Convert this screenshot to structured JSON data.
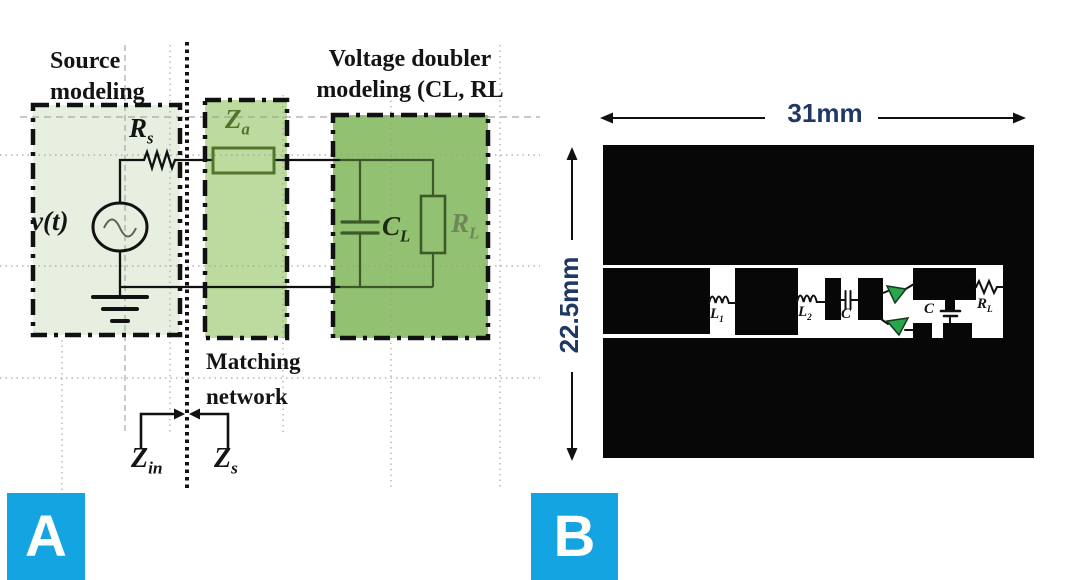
{
  "figure": {
    "panel_a": {
      "badge": "A",
      "source_title": {
        "line1": "Source",
        "line2": "modeling"
      },
      "doubler_title": {
        "line1": "Voltage doubler",
        "line2": "modeling (CL, RL"
      },
      "matching_label": {
        "line1": "Matching",
        "line2": "network"
      },
      "source_label": "v(t)",
      "rs": {
        "main": "R",
        "sub": "s"
      },
      "za": {
        "main": "Z",
        "sub": "a"
      },
      "cl": {
        "main": "C",
        "sub": "L"
      },
      "rl": {
        "main": "R",
        "sub": "L"
      },
      "zin": {
        "main": "Z",
        "sub": "in"
      },
      "zs": {
        "main": "Z",
        "sub": "s"
      }
    },
    "panel_b": {
      "badge": "B",
      "width_dim": "31mm",
      "height_dim": "22.5mm",
      "l1": {
        "main": "L",
        "sub": "1"
      },
      "l2": {
        "main": "L",
        "sub": "2"
      },
      "c_series": "C",
      "c_shunt": "C",
      "rl": {
        "main": "R",
        "sub": "L"
      }
    },
    "colors": {
      "badge_blue": "#14a4e1",
      "source_box_fill": "#e7efe0",
      "matching_box_fill": "#bedb9f",
      "doubler_box_fill": "#92c171",
      "olive_green": "#53742c",
      "dark_green": "#3c5a28",
      "label_gray_green": "#6f8758",
      "dimension_text": "#1f3864",
      "diode_green": "#2aa54c",
      "pcb_black": "#070707"
    }
  }
}
